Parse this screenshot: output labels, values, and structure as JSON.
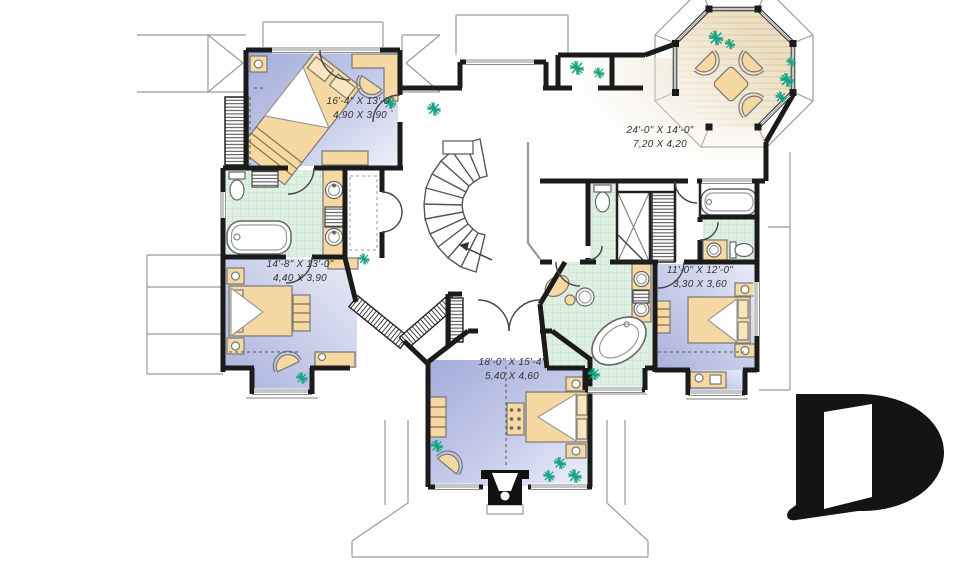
{
  "plan": {
    "rooms": [
      {
        "name": "bedroom-top-left",
        "imperial": "16'-4\" X 13'-0\"",
        "metric": "4,90 X 3,90"
      },
      {
        "name": "bonus-room",
        "imperial": "24'-0\" X 14'-0\"",
        "metric": "7,20 X 4,20"
      },
      {
        "name": "bedroom-left",
        "imperial": "14'-8\" X 13'-0\"",
        "metric": "4,40 X 3,90"
      },
      {
        "name": "bedroom-right",
        "imperial": "11'-0\" X 12'-0\"",
        "metric": "3,30 X 3,60"
      },
      {
        "name": "master-bedroom",
        "imperial": "18'-0\" X 15'-4\"",
        "metric": "5,40 X 4,60"
      }
    ],
    "logo_letter": "D",
    "colors": {
      "wall": "#1b1b1b",
      "carpet_dark": "#a8b1dc",
      "carpet_light": "#eef0fa",
      "tile": "#dff0e3",
      "tile_line": "#c2e2cc",
      "wood": "#ecdfc2",
      "wood_line": "#d9c6a0",
      "furniture": "#f6d9a2",
      "plant": "#17a283",
      "label_text": "#343434",
      "logo": "#141414"
    }
  }
}
